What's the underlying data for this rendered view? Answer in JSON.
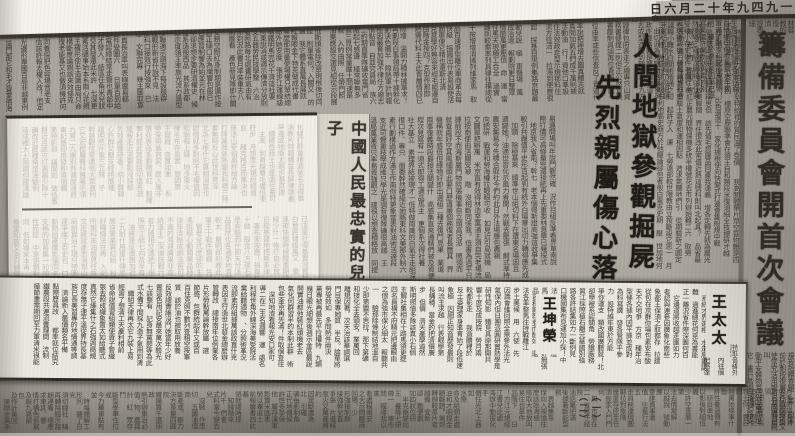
{
  "page": {
    "date_line": "一九四九年十二月六日",
    "masthead_headline": "籌備委員會開首次會議",
    "main_headline": {
      "line1": "人間地獄參觀掘屍",
      "line2": "先烈親屬傷心落淚"
    },
    "left_headline": "中國人民最忠實的兒子",
    "names": {
      "right": "王太太",
      "center": "王坤榮"
    },
    "section_markers": "（一）（二）",
    "colors": {
      "paper": "#aaa69e",
      "scan_margin": "#f6f4ef",
      "clipping": "#f2efe7",
      "strip": "#ebe8df",
      "ink": "#221f1a"
    },
    "filler_glyphs": "的一是在不了有和人這中大為上個國我以要他時來用們生到作地於出就分對成會可主發年動同工也能下過子說產種面而方後多定行學法所民得經十三之進著等部度家電力裡如水化高自二理起小物現實加量都兩體制機當使點從業本去把性好應開它合還因由其些然前外天政四日那社義事平形相全表間樣與關各重新線內數正心反你明看原又麼利比或但質氣第向道命此變條只沒結解問意建月公無系軍很情者最立代想已通並提直題黨程展五果料象員革位入常文總次品式活設及管特件長求老頭基資邊流路級少圖山統接知較將組見計別她手角期根論運農指幾九區強放決西被幹做必戰先回則任取據處隊南給色光門即保治北造百規熱領七海口東導器壓志世金增爭濟階油思術極交受聯什認六共權收證改清美再採轉更單風切打白教速花帶安場身車例真務具萬每目至達走積示議聲報鬥完類八離華名確才科張信馬節話米整空元況今集溫傳土許步群廣石記需段研界拉林律叫且究觀越織裝影算低持音眾書布復容兒須際商非驗連斷深難近礦千週委素技備半辦青省列習響約支般史感勞便團往酸歷市克何除消構府稱太準精值號率族維劃選標寫存候毛親快效斯院查江型眼王按格養易置派層片始卻專狀育廠京識適屬圓包火住調滿縣局照參紅細引聽該鐵價嚴，。、？！"
  }
}
